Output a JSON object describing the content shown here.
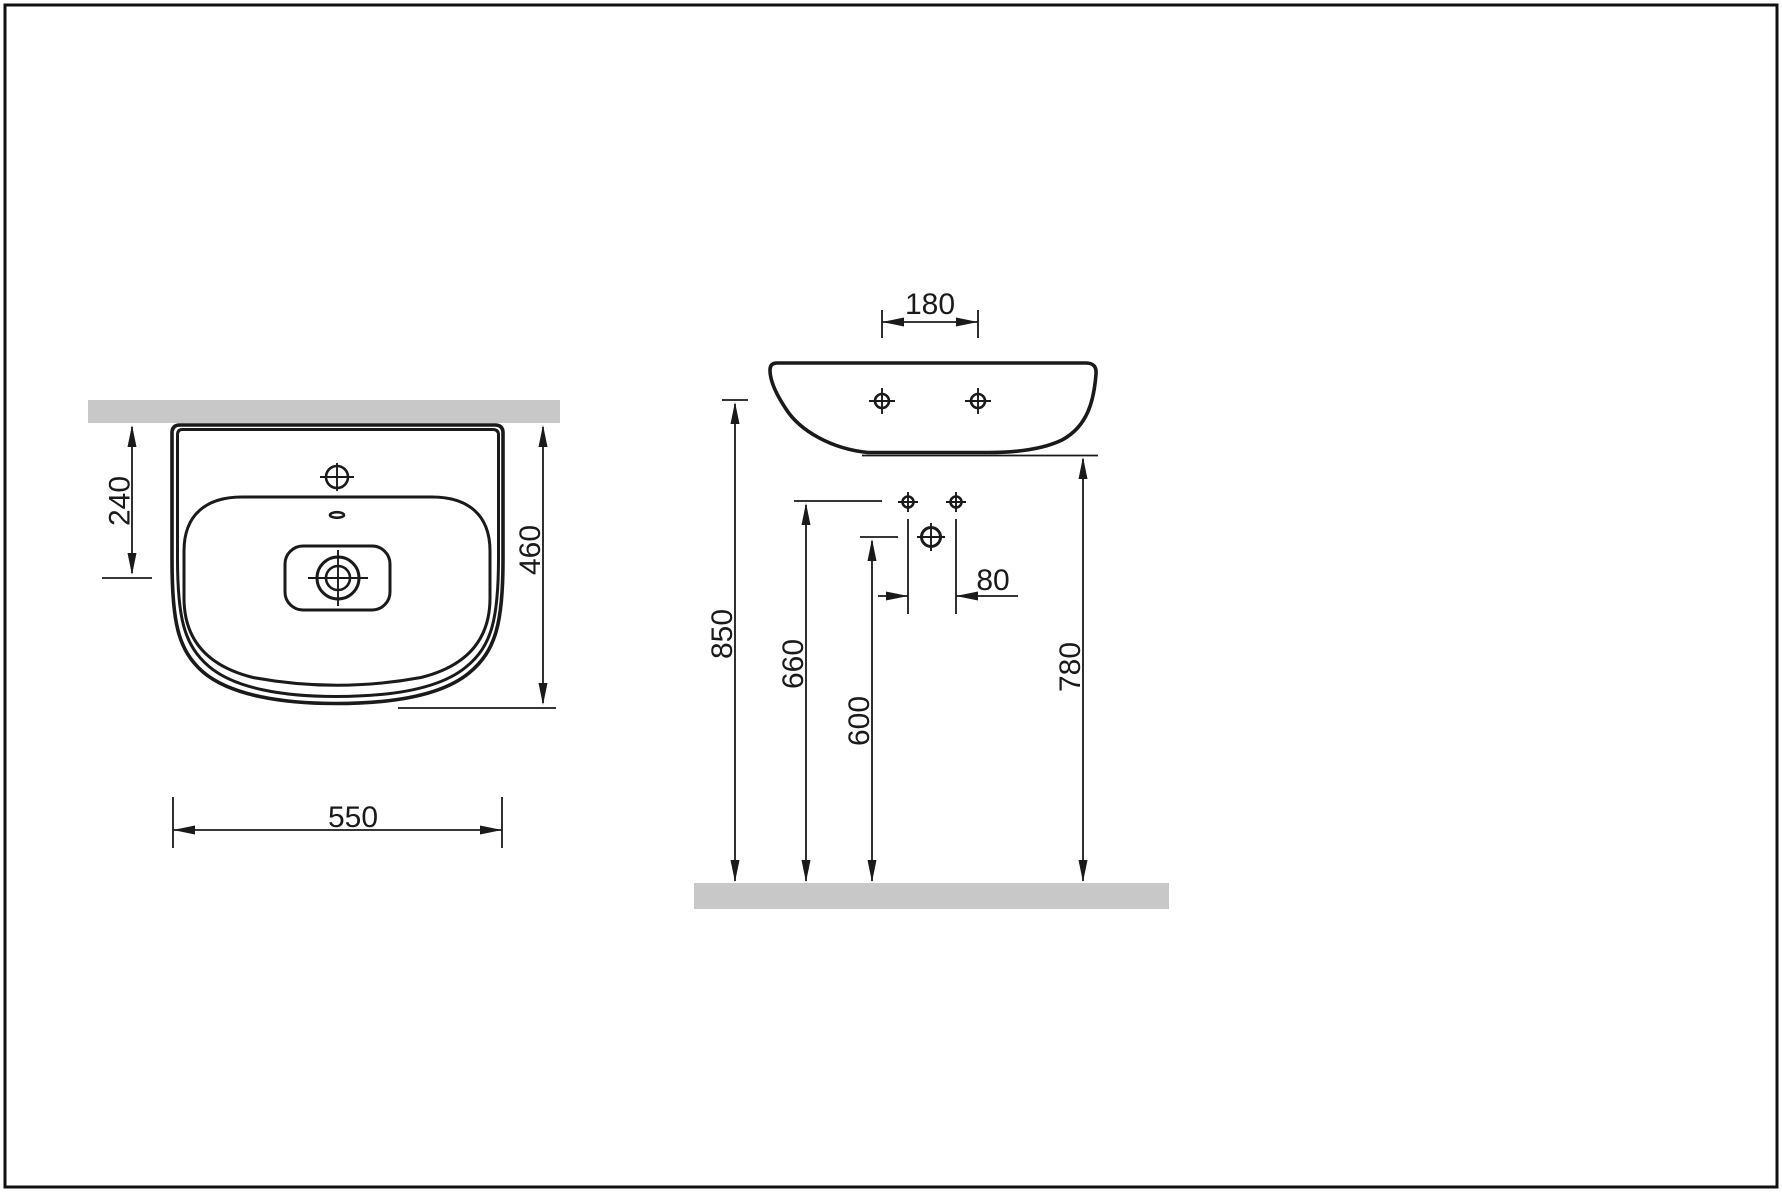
{
  "title": "Wall-hung washbasin installation drawing",
  "views": {
    "plan": {
      "label": "plan-view",
      "dimensions": {
        "wall_to_drain": "240",
        "depth": "460",
        "width": "550"
      }
    },
    "front": {
      "label": "front-view",
      "dimensions": {
        "tap_hole_spacing": "180",
        "fixing_hole_spacing": "80",
        "rim_height": "850",
        "fixing_holes_height": "660",
        "drain_height": "600",
        "underside_height": "780"
      }
    }
  },
  "colors": {
    "line": "#1a1a1a",
    "surface_gray": "#c8c8c8",
    "background": "#ffffff"
  }
}
